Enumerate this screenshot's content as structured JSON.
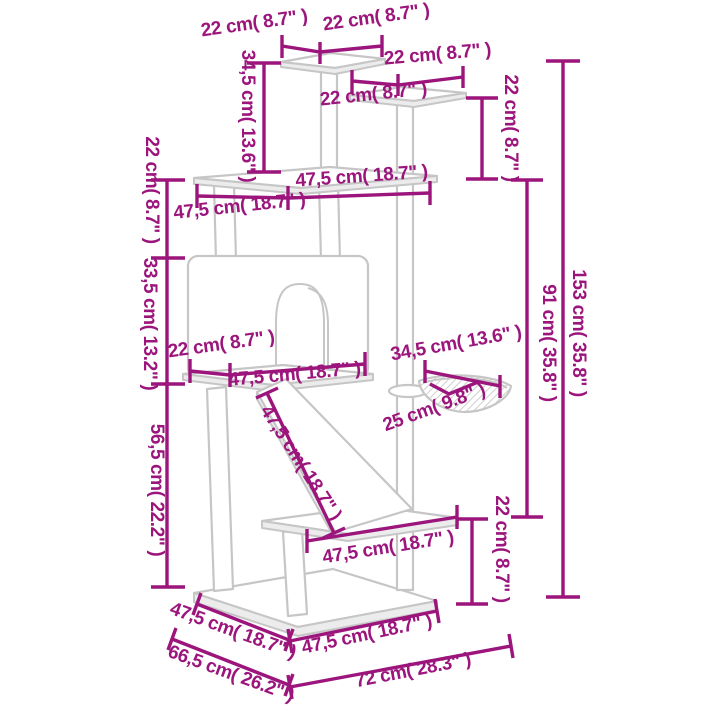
{
  "colors": {
    "dimension": "#9C157C",
    "drawing_outline": "#C6C6C6"
  },
  "labels": {
    "top1_left": "22 cm( 8.7\" )",
    "top1_right": "22 cm( 8.7\" )",
    "top2_right": "22 cm( 8.7\" )",
    "top2_left": "22 cm( 8.7\" )",
    "right_post": "22 cm( 8.7\" )",
    "drop_345": "34,5 cm( 13.6\" )",
    "left_22": "22 cm( 8.7\" )",
    "left_335": "33,5 cm( 13.2\" )",
    "left_565": "56,5 cm( 22.2\" )",
    "platform_right": "47,5 cm( 18.7\" )",
    "platform_left": "47,5 cm( 18.7\" )",
    "house_22": "22 cm( 8.7\" )",
    "house_475": "47,5 cm( 18.7\" )",
    "basket_345": "34,5 cm( 13.6\" )",
    "basket_25": "25 cm( 9.8\" )",
    "ramp_475": "47,5 cm( 18.7\" )",
    "mid_475": "47,5 cm( 18.7\" )",
    "lower_22": "22 cm( 8.7\" )",
    "h91": "91 cm( 35.8\" )",
    "h153": "153 cm( 35.8\" )",
    "base_left_475": "47,5 cm( 18.7\" )",
    "base_665": "66,5 cm( 26.2\" )",
    "base_bottom_475": "47,5 cm( 18.7\" )",
    "base_72": "72 cm( 28.3\" )"
  }
}
